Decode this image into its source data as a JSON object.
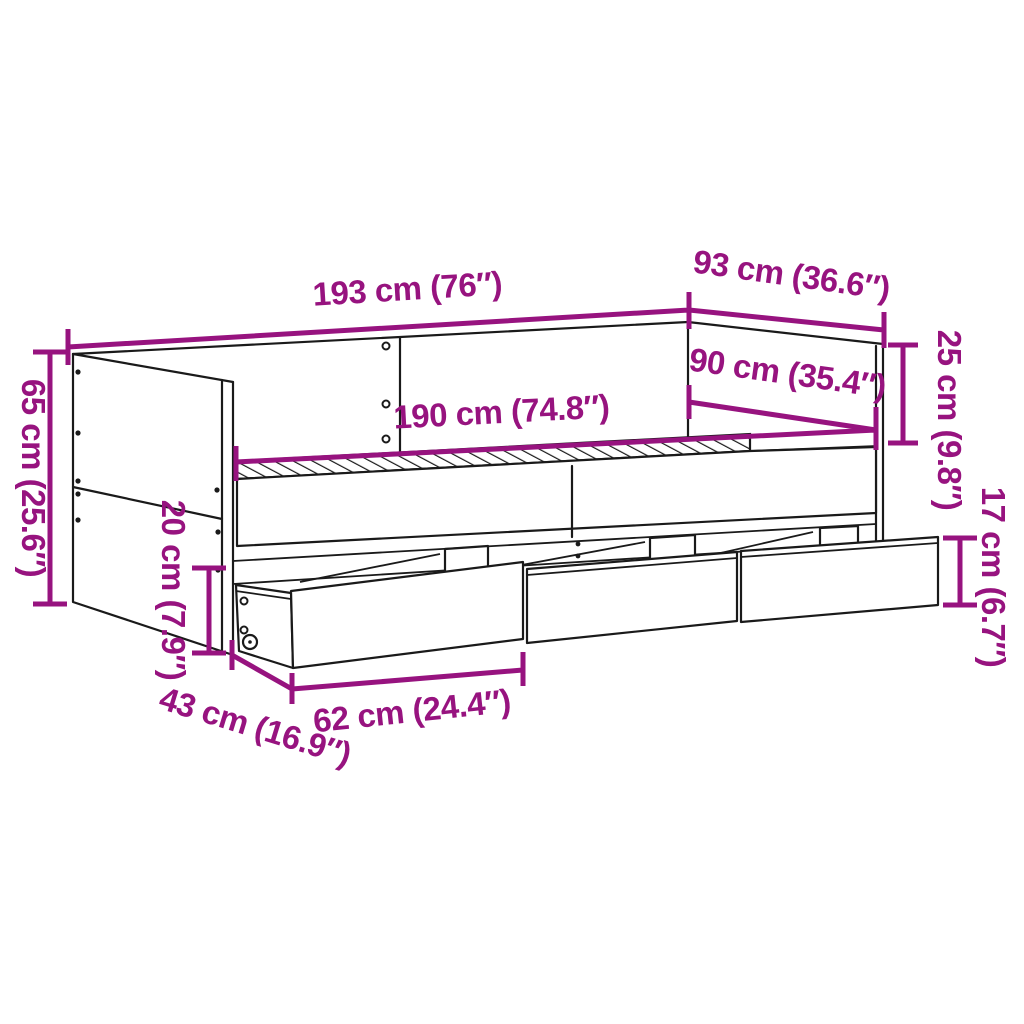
{
  "page": {
    "title": "Daybed with drawers – dimension diagram",
    "background": "#ffffff"
  },
  "diagram": {
    "subject": "daybed-with-storage-drawers",
    "colors": {
      "dimension": "#97137f",
      "outline": "#1a1a1a",
      "background": "#ffffff"
    },
    "dimensions": {
      "total_width": {
        "label": "193 cm (76″)"
      },
      "total_depth": {
        "label": "93 cm (36.6″)"
      },
      "backrest_height": {
        "label": "25 cm (9.8″)"
      },
      "bed_width": {
        "label": "90 cm (35.4″)"
      },
      "bed_length": {
        "label": "190 cm (74.8″)"
      },
      "total_height": {
        "label": "65 cm (25.6″)"
      },
      "clearance_height": {
        "label": "20 cm (7.9″)"
      },
      "drawer_height": {
        "label": "17 cm (6.7″)"
      },
      "drawer_depth": {
        "label": "43 cm (16.9″)"
      },
      "drawer_width": {
        "label": "62 cm (24.4″)"
      }
    }
  }
}
